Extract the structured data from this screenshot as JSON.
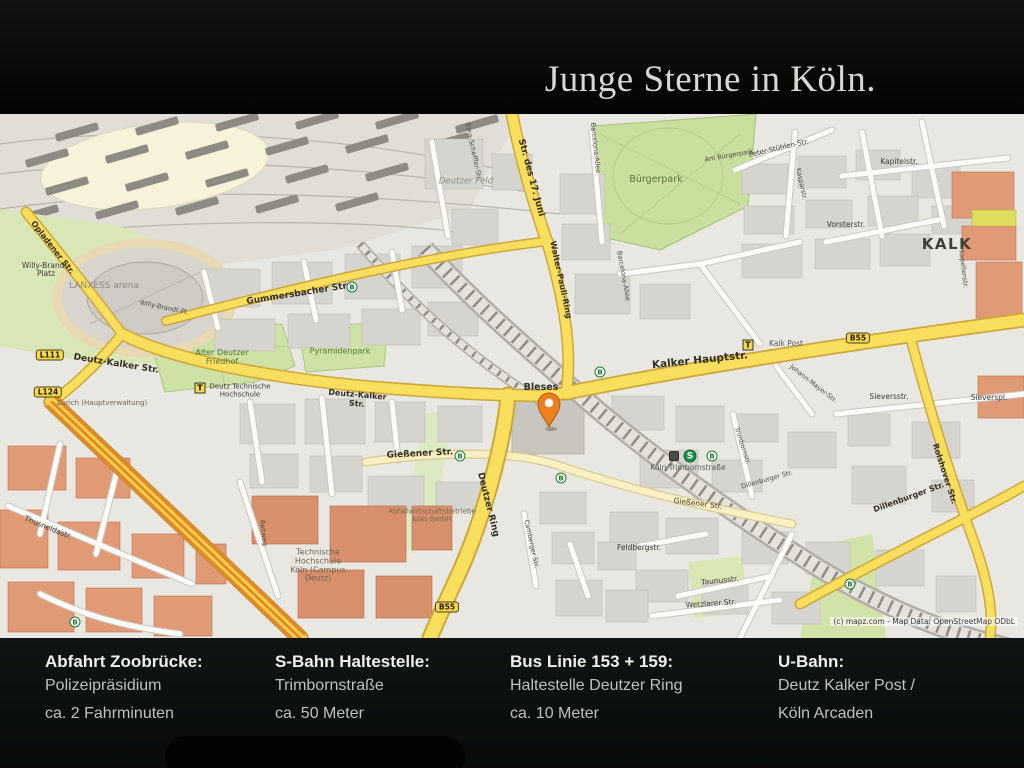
{
  "colors": {
    "header_bg": "#0b0a08",
    "footer_bg": "#0d1110",
    "map_bg": "#e9e7e1",
    "road_yellow": "#fadf5e",
    "trunk_orange": "#e2862a",
    "park_green": "#cde2a4",
    "pin_orange": "#ee7f1f",
    "sbahn_green": "#159048"
  },
  "header": {
    "title": "Junge Sterne in Köln."
  },
  "map": {
    "attribution": "(c) mapz.com - Map Data: OpenStreetMap ODbL",
    "labels": [
      {
        "t": "Opladener Str.",
        "x": 52,
        "y": 134,
        "r": 52,
        "c": "sty8"
      },
      {
        "t": "Willy-Brandt-\nPlatz",
        "x": 46,
        "y": 156,
        "c": "st"
      },
      {
        "t": "Willy-Brandt-Pl.",
        "x": 164,
        "y": 194,
        "r": 12,
        "c": "tiny"
      },
      {
        "t": "LANXESS arena",
        "x": 104,
        "y": 173,
        "c": "arena"
      },
      {
        "t": "Gummersbacher Str.",
        "x": 298,
        "y": 181,
        "r": -9,
        "c": "sty9"
      },
      {
        "t": "Deutz-Kalker Str.",
        "x": 116,
        "y": 251,
        "r": 9,
        "c": "sty9"
      },
      {
        "t": "Zurich (Hauptverwaltung)",
        "x": 102,
        "y": 290,
        "c": "poi"
      },
      {
        "t": "Alter Deutzer\nFriedhof",
        "x": 222,
        "y": 244,
        "c": "park"
      },
      {
        "t": "Pyramidenpark",
        "x": 340,
        "y": 238,
        "c": "park"
      },
      {
        "t": "Deutz Technische\nHochschule",
        "x": 240,
        "y": 277,
        "c": "st7"
      },
      {
        "t": "Deutz-Kalker\nStr.",
        "x": 357,
        "y": 286,
        "r": 5,
        "c": "sty8"
      },
      {
        "t": "Gießener Str.",
        "x": 420,
        "y": 341,
        "r": -3,
        "c": "sty9"
      },
      {
        "t": "Deutzer Ring",
        "x": 487,
        "y": 391,
        "r": 76,
        "c": "sty9"
      },
      {
        "t": "Abfallwirtschaftsbetriebe\nKöln GmbH",
        "x": 432,
        "y": 402,
        "c": "poi"
      },
      {
        "t": "Technische\nHochschule\nKöln (Campus\nDeutz)",
        "x": 318,
        "y": 452,
        "c": "poi8"
      },
      {
        "t": "Reitweg",
        "x": 263,
        "y": 419,
        "r": 83,
        "c": "tiny"
      },
      {
        "t": "Thusneldastr.",
        "x": 48,
        "y": 414,
        "r": 22,
        "c": "st"
      },
      {
        "t": "Str. des 17. Juni",
        "x": 530,
        "y": 64,
        "r": 75,
        "c": "sty9"
      },
      {
        "t": "Deutzer Feld",
        "x": 466,
        "y": 68,
        "c": "area"
      },
      {
        "t": "Erna-Scheffler-Str.",
        "x": 473,
        "y": 38,
        "r": 78,
        "c": "tiny"
      },
      {
        "t": "Walter-Pauli-Ring",
        "x": 560,
        "y": 166,
        "r": 78,
        "c": "sty8"
      },
      {
        "t": "Barcelona-Allee",
        "x": 595,
        "y": 34,
        "r": 84,
        "c": "tiny"
      },
      {
        "t": "Barcelona-Allee",
        "x": 623,
        "y": 162,
        "r": 80,
        "c": "tiny"
      },
      {
        "t": "Bürgerpark",
        "x": 656,
        "y": 66,
        "c": "park9"
      },
      {
        "t": "Am Bürgerpark",
        "x": 729,
        "y": 42,
        "r": -10,
        "c": "tiny"
      },
      {
        "t": "Peter-Stühlen-Str.",
        "x": 779,
        "y": 35,
        "r": -13,
        "c": "st7"
      },
      {
        "t": "Kasparstr.",
        "x": 801,
        "y": 70,
        "r": 78,
        "c": "tiny"
      },
      {
        "t": "Kapitelstr.",
        "x": 899,
        "y": 48,
        "c": "st"
      },
      {
        "t": "Vorsterstr.",
        "x": 846,
        "y": 111,
        "c": "st"
      },
      {
        "t": "KALK",
        "x": 947,
        "y": 130,
        "c": "dist"
      },
      {
        "t": "Kapellenstr.",
        "x": 963,
        "y": 155,
        "r": 83,
        "c": "tiny"
      },
      {
        "t": "Kalker Hauptstr.",
        "x": 700,
        "y": 247,
        "r": -6,
        "c": "sty10"
      },
      {
        "t": "Kalk Post",
        "x": 786,
        "y": 230,
        "c": "stop"
      },
      {
        "t": "Johann-Mayer-Str.",
        "x": 813,
        "y": 270,
        "r": 38,
        "c": "tiny"
      },
      {
        "t": "Sieversstr.",
        "x": 889,
        "y": 283,
        "c": "st"
      },
      {
        "t": "Sieverspl.",
        "x": 989,
        "y": 284,
        "c": "st"
      },
      {
        "t": "Rolshover Str.",
        "x": 944,
        "y": 360,
        "r": 72,
        "c": "sty8"
      },
      {
        "t": "Dillenburger Str.",
        "x": 909,
        "y": 384,
        "r": -20,
        "c": "sty8"
      },
      {
        "t": "Dillenburger Str.",
        "x": 767,
        "y": 366,
        "r": -16,
        "c": "tiny"
      },
      {
        "t": "Trimbornstr.",
        "x": 742,
        "y": 332,
        "r": 72,
        "c": "tiny"
      },
      {
        "t": "Köln Trimbornstraße",
        "x": 688,
        "y": 354,
        "c": "stop"
      },
      {
        "t": "Gießener Str.",
        "x": 698,
        "y": 390,
        "r": 7,
        "c": "st"
      },
      {
        "t": "Feldbergstr.",
        "x": 639,
        "y": 434,
        "c": "st"
      },
      {
        "t": "Taunusstr.",
        "x": 720,
        "y": 467,
        "r": -6,
        "c": "st"
      },
      {
        "t": "Wetzlarer Str.",
        "x": 711,
        "y": 490,
        "r": -4,
        "c": "st"
      },
      {
        "t": "Camberger Str.",
        "x": 531,
        "y": 430,
        "r": 78,
        "c": "tiny"
      },
      {
        "t": "Bleses",
        "x": 541,
        "y": 274,
        "c": "poid"
      }
    ],
    "badges": [
      {
        "type": "lbadge",
        "t": "L111",
        "x": 50,
        "y": 241,
        "name": "route-badge-l111"
      },
      {
        "type": "lbadge",
        "t": "L124",
        "x": 48,
        "y": 278,
        "name": "route-badge-l124"
      },
      {
        "type": "lbadge",
        "t": "B55",
        "x": 858,
        "y": 224,
        "name": "route-badge-b55"
      },
      {
        "type": "lbadge",
        "t": "B55",
        "x": 447,
        "y": 493,
        "name": "route-badge-b55"
      },
      {
        "type": "bcircle",
        "t": "B",
        "x": 352,
        "y": 173,
        "name": "bus-stop-badge"
      },
      {
        "type": "bcircle",
        "t": "B",
        "x": 460,
        "y": 342,
        "name": "bus-stop-badge"
      },
      {
        "type": "bcircle",
        "t": "B",
        "x": 600,
        "y": 258,
        "name": "bus-stop-badge"
      },
      {
        "type": "bcircle",
        "t": "B",
        "x": 561,
        "y": 364,
        "name": "bus-stop-badge"
      },
      {
        "type": "bcircle",
        "t": "B",
        "x": 75,
        "y": 508,
        "name": "bus-stop-badge"
      },
      {
        "type": "bcircle",
        "t": "B",
        "x": 850,
        "y": 470,
        "name": "bus-stop-badge"
      },
      {
        "type": "bcircle",
        "t": "B",
        "x": 712,
        "y": 342,
        "name": "bus-stop-badge"
      },
      {
        "type": "ssq",
        "t": "",
        "x": 674,
        "y": 342,
        "name": "station-icon"
      },
      {
        "type": "scircle",
        "t": "S",
        "x": 690,
        "y": 342,
        "name": "sbahn-badge"
      },
      {
        "type": "tsquare",
        "t": "T",
        "x": 200,
        "y": 274,
        "name": "tram-stop-badge"
      },
      {
        "type": "tsquare",
        "t": "T",
        "x": 748,
        "y": 231,
        "name": "tram-stop-badge"
      }
    ]
  },
  "footer": {
    "columns": [
      {
        "heading": "Abfahrt Zoobrücke:",
        "lines": [
          "Polizeipräsidium",
          "ca. 2 Fahrminuten"
        ]
      },
      {
        "heading": "S-Bahn Haltestelle:",
        "lines": [
          "Trimbornstraße",
          "ca. 50 Meter"
        ]
      },
      {
        "heading": "Bus Linie 153 + 159:",
        "lines": [
          "Haltestelle Deutzer Ring",
          "ca. 10 Meter"
        ]
      },
      {
        "heading": "U-Bahn:",
        "lines": [
          "Deutz Kalker Post /",
          "Köln Arcaden"
        ]
      }
    ]
  }
}
